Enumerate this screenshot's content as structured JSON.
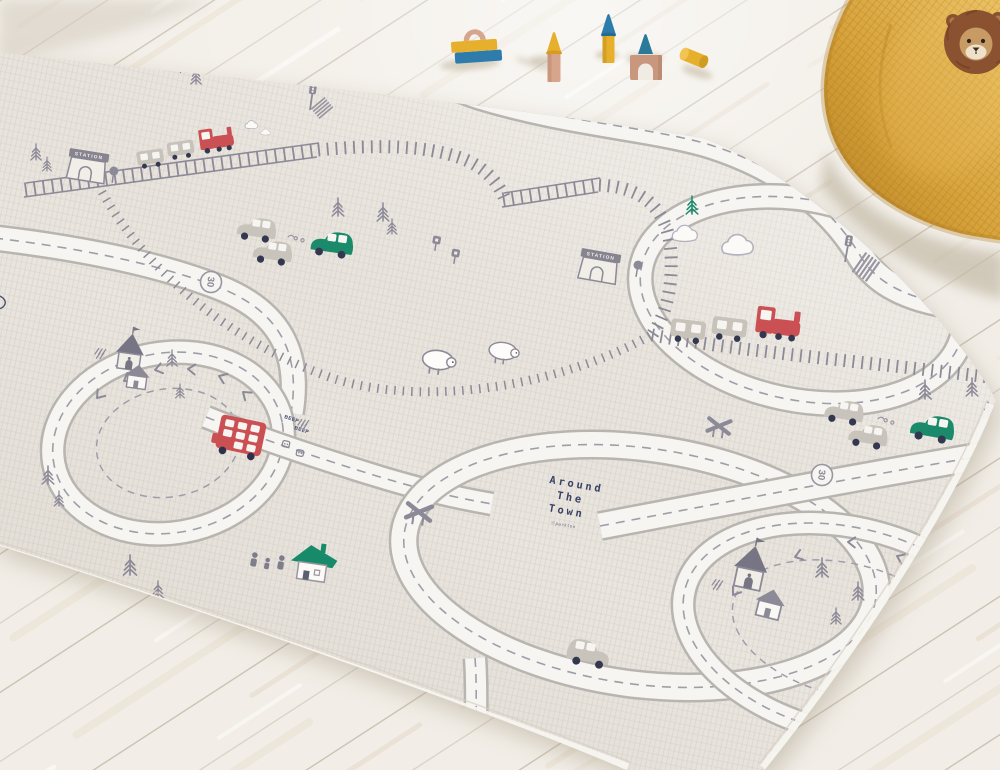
{
  "scene": {
    "type": "photograph",
    "description": "Angled photo of a baby play mat printed with an 'Around The Town' road-map design lying on a whitewashed wooden plank floor, with wooden toy blocks, a mustard waffle-knit floor cushion and a plush lion in the top-right corner",
    "lighting": "soft daylight from the upper right"
  },
  "colors": {
    "floor": "#f2eee7",
    "plank_line": "#a99c85",
    "mat_base": "#e9e5df",
    "road_fill": "#f7f5f1",
    "road_edge": "#b8b4af",
    "print_gray": "#8d8a98",
    "print_navy": "#3a4366",
    "accent_red": "#cb5054",
    "accent_green": "#1b8a6b",
    "cushion": "#d9a43c",
    "block_yellow": "#e7b02c",
    "block_blue": "#2d7cab",
    "block_pink": "#d7a48c"
  },
  "mat": {
    "title": {
      "line1": "Around",
      "line2": "The",
      "line3": "Town",
      "credit": "ⓒparklon"
    },
    "station_sign": "STATION",
    "bus_text": "BEEP",
    "speed_sign": "30",
    "landmarks": [
      "two train stations",
      "railway with steam trains",
      "red double-decker bus",
      "churches with flags",
      "outlined cottages",
      "green-roof house",
      "sheep pair",
      "pine trees",
      "traffic lights",
      "crosswalks",
      "level crossings",
      "loop roads with chevrons",
      "gray and green cars"
    ]
  },
  "toys": {
    "blocks": [
      {
        "name": "stacked bars with arch",
        "colors": [
          "yellow",
          "blue",
          "pink"
        ]
      },
      {
        "name": "column with cone cap",
        "colors": [
          "pink",
          "yellow"
        ]
      },
      {
        "name": "column with cone cap",
        "colors": [
          "yellow",
          "blue"
        ]
      },
      {
        "name": "arch block with cone",
        "colors": [
          "pink",
          "teal"
        ]
      },
      {
        "name": "lying cylinder",
        "colors": [
          "yellow"
        ]
      }
    ]
  },
  "cushion": {
    "style": "waffle-knit floor cushion",
    "color_name": "mustard"
  },
  "plush": {
    "animal": "lion",
    "colors": [
      "brown",
      "tan",
      "cream"
    ]
  }
}
